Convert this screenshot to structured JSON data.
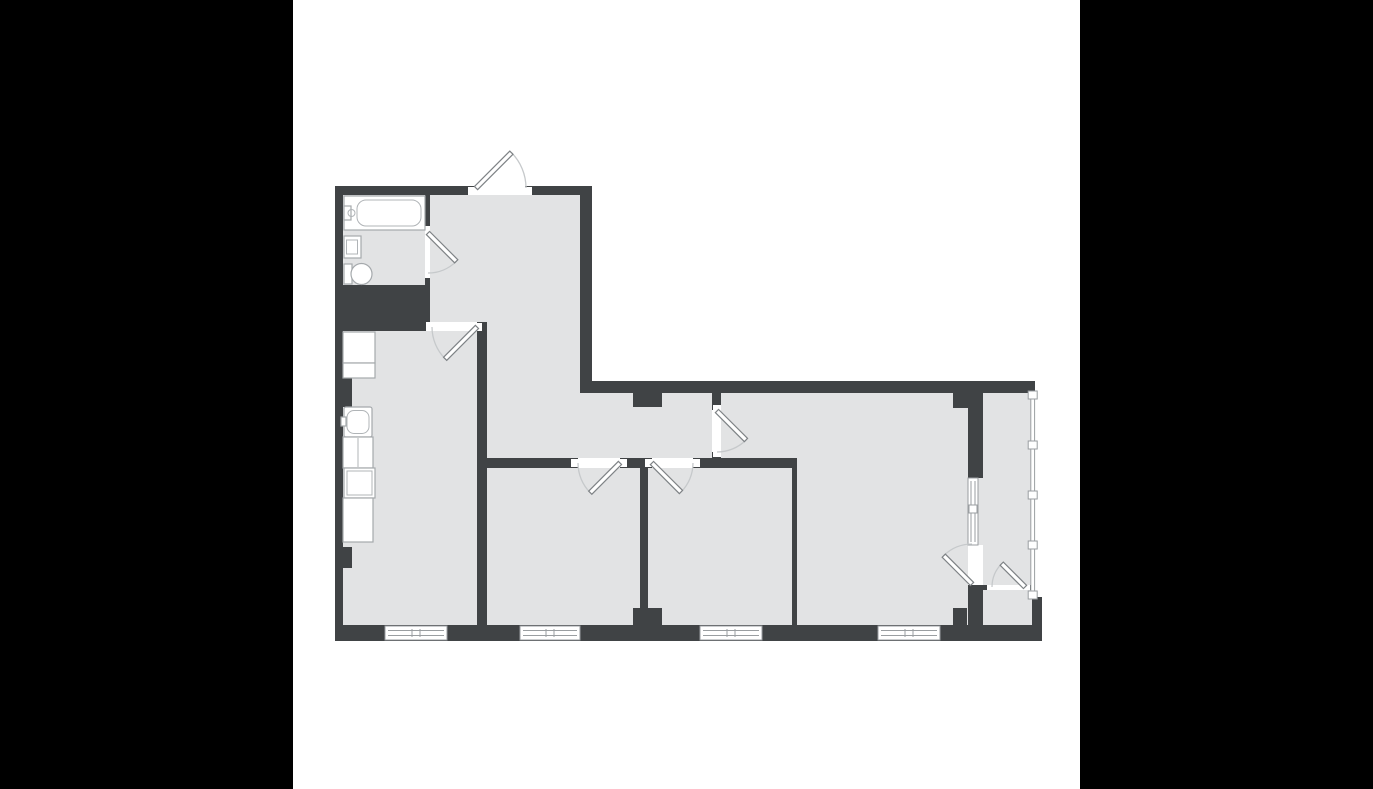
{
  "meta": {
    "type": "apartment-floor-plan",
    "has_text": false
  },
  "palette": {
    "letterbox": "#000000",
    "canvas": "#ffffff",
    "wall": "#404345",
    "floor": "#e2e3e4",
    "window_frame": "#9a9ea1",
    "door_leaf_border": "#7e8285",
    "door_swing_arc": "#c6c9cb",
    "fixture_border": "#a5a9ac"
  },
  "canvas": {
    "x": 293,
    "y": 0,
    "w": 787,
    "h": 789
  },
  "shapes": [
    {
      "n": "plan-canvas",
      "c": "canvas",
      "t": "rect",
      "x": 293,
      "y": 0,
      "w": 787,
      "h": 789
    },
    {
      "n": "floor-left-wing",
      "c": "floor",
      "t": "rect",
      "x": 343,
      "y": 195,
      "w": 248,
      "h": 446
    },
    {
      "n": "floor-right-wing",
      "c": "floor",
      "t": "rect",
      "x": 591,
      "y": 381,
      "w": 444,
      "h": 260
    },
    {
      "n": "top-wall-west",
      "c": "wall",
      "t": "rect",
      "x": 335,
      "y": 186,
      "w": 140,
      "h": 9
    },
    {
      "n": "top-wall-entry-east",
      "c": "wall",
      "t": "rect",
      "x": 525,
      "y": 186,
      "w": 67,
      "h": 9
    },
    {
      "n": "west-wall",
      "c": "wall",
      "t": "rect",
      "x": 335,
      "y": 186,
      "w": 8,
      "h": 455
    },
    {
      "n": "south-wall",
      "c": "wall",
      "t": "rect",
      "x": 335,
      "y": 625,
      "w": 707,
      "h": 16
    },
    {
      "n": "hall-east-wall",
      "c": "wall",
      "t": "rect",
      "x": 580,
      "y": 186,
      "w": 12,
      "h": 207
    },
    {
      "n": "north-wall-east",
      "c": "wall",
      "t": "rect",
      "x": 580,
      "y": 381,
      "w": 455,
      "h": 12
    },
    {
      "n": "bathroom-east-wall-upper",
      "c": "wall",
      "t": "rect",
      "x": 425,
      "y": 195,
      "w": 5,
      "h": 37
    },
    {
      "n": "bathroom-east-wall-lower",
      "c": "wall",
      "t": "rect",
      "x": 425,
      "y": 272,
      "w": 5,
      "h": 14
    },
    {
      "n": "bathroom-kitchen-band",
      "c": "wall",
      "t": "rect",
      "x": 335,
      "y": 285,
      "w": 95,
      "h": 46
    },
    {
      "n": "kitchen-east-wall",
      "c": "wall",
      "t": "rect",
      "x": 477,
      "y": 322,
      "w": 10,
      "h": 319
    },
    {
      "n": "corridor-south-wall-a",
      "c": "wall",
      "t": "rect",
      "x": 487,
      "y": 458,
      "w": 91,
      "h": 10
    },
    {
      "n": "corridor-south-wall-b",
      "c": "wall",
      "t": "rect",
      "x": 620,
      "y": 458,
      "w": 32,
      "h": 10
    },
    {
      "n": "corridor-south-wall-c",
      "c": "wall",
      "t": "rect",
      "x": 693,
      "y": 458,
      "w": 104,
      "h": 10
    },
    {
      "n": "room2-room3-wall",
      "c": "wall",
      "t": "rect",
      "x": 640,
      "y": 468,
      "w": 8,
      "h": 140
    },
    {
      "n": "room2-room3-pillar",
      "c": "wall",
      "t": "rect",
      "x": 633,
      "y": 608,
      "w": 29,
      "h": 17
    },
    {
      "n": "corridor-pillar",
      "c": "wall",
      "t": "rect",
      "x": 633,
      "y": 393,
      "w": 29,
      "h": 14
    },
    {
      "n": "livingroom-door-stub-north",
      "c": "wall",
      "t": "rect",
      "x": 712,
      "y": 393,
      "w": 9,
      "h": 17
    },
    {
      "n": "livingroom-door-stub-south",
      "c": "wall",
      "t": "rect",
      "x": 712,
      "y": 452,
      "w": 9,
      "h": 16
    },
    {
      "n": "room3-livingroom-wall",
      "c": "wall",
      "t": "rect",
      "x": 792,
      "y": 468,
      "w": 5,
      "h": 157
    },
    {
      "n": "balcony-west-wall-upper",
      "c": "wall",
      "t": "rect",
      "x": 968,
      "y": 393,
      "w": 15,
      "h": 85
    },
    {
      "n": "balcony-west-wall-lower",
      "c": "wall",
      "t": "rect",
      "x": 968,
      "y": 585,
      "w": 15,
      "h": 40
    },
    {
      "n": "livingroom-ne-protrusion",
      "c": "wall",
      "t": "rect",
      "x": 953,
      "y": 393,
      "w": 15,
      "h": 15
    },
    {
      "n": "livingroom-se-protrusion",
      "c": "wall",
      "t": "rect",
      "x": 953,
      "y": 608,
      "w": 14,
      "h": 17
    },
    {
      "n": "balcony-divider-west",
      "c": "wall",
      "t": "rect",
      "x": 982,
      "y": 585,
      "w": 10,
      "h": 5
    },
    {
      "n": "balcony-divider-east",
      "c": "wall",
      "t": "rect",
      "x": 1025,
      "y": 585,
      "w": 6,
      "h": 5
    },
    {
      "n": "southeast-block",
      "c": "wall",
      "t": "rect",
      "x": 1032,
      "y": 597,
      "w": 10,
      "h": 43
    },
    {
      "n": "kitchen-wall-nub-upper",
      "c": "wall",
      "t": "rect",
      "x": 343,
      "y": 378,
      "w": 9,
      "h": 29
    },
    {
      "n": "kitchen-wall-nub-lower",
      "c": "wall",
      "t": "rect",
      "x": 343,
      "y": 547,
      "w": 9,
      "h": 21
    },
    {
      "n": "entry-doorway",
      "c": "open",
      "t": "rect",
      "x": 475,
      "y": 186,
      "w": 50,
      "h": 9
    },
    {
      "n": "bathroom-doorway",
      "c": "open",
      "t": "rect",
      "x": 425,
      "y": 232,
      "w": 5,
      "h": 40
    },
    {
      "n": "kitchen-doorway",
      "c": "open",
      "t": "rect",
      "x": 432,
      "y": 322,
      "w": 45,
      "h": 9
    },
    {
      "n": "room2-doorway",
      "c": "open",
      "t": "rect",
      "x": 578,
      "y": 458,
      "w": 42,
      "h": 10
    },
    {
      "n": "room3-doorway",
      "c": "open",
      "t": "rect",
      "x": 652,
      "y": 458,
      "w": 41,
      "h": 10
    },
    {
      "n": "livingroom-doorway",
      "c": "open",
      "t": "rect",
      "x": 712,
      "y": 410,
      "w": 9,
      "h": 42
    },
    {
      "n": "balcony-doorway",
      "c": "open",
      "t": "rect",
      "x": 968,
      "y": 545,
      "w": 15,
      "h": 40
    },
    {
      "n": "balcony-lower-doorway",
      "c": "open",
      "t": "rect",
      "x": 992,
      "y": 585,
      "w": 33,
      "h": 5
    },
    {
      "n": "entry-door-jamb-west",
      "c": "open",
      "t": "rect",
      "x": 468,
      "y": 187,
      "w": 7,
      "h": 8
    },
    {
      "n": "entry-door-jamb-east",
      "c": "open",
      "t": "rect",
      "x": 525,
      "y": 187,
      "w": 7,
      "h": 8
    },
    {
      "n": "bathroom-door-jamb-north",
      "c": "open",
      "t": "rect",
      "x": 425,
      "y": 226,
      "w": 5,
      "h": 6
    },
    {
      "n": "bathroom-door-jamb-south",
      "c": "open",
      "t": "rect",
      "x": 425,
      "y": 272,
      "w": 5,
      "h": 6
    },
    {
      "n": "kitchen-door-jamb-west",
      "c": "open",
      "t": "rect",
      "x": 426,
      "y": 322,
      "w": 6,
      "h": 9
    },
    {
      "n": "kitchen-door-jamb-east",
      "c": "open",
      "t": "rect",
      "x": 477,
      "y": 323,
      "w": 5,
      "h": 8
    },
    {
      "n": "room2-door-jamb-west",
      "c": "open",
      "t": "rect",
      "x": 571,
      "y": 459,
      "w": 7,
      "h": 8
    },
    {
      "n": "room2-door-jamb-east",
      "c": "open",
      "t": "rect",
      "x": 620,
      "y": 459,
      "w": 7,
      "h": 8
    },
    {
      "n": "room3-door-jamb-west",
      "c": "open",
      "t": "rect",
      "x": 645,
      "y": 459,
      "w": 7,
      "h": 8
    },
    {
      "n": "room3-door-jamb-east",
      "c": "open",
      "t": "rect",
      "x": 693,
      "y": 459,
      "w": 7,
      "h": 8
    },
    {
      "n": "livingroom-door-jamb-north",
      "c": "open",
      "t": "rect",
      "x": 713,
      "y": 405,
      "w": 8,
      "h": 5
    },
    {
      "n": "livingroom-door-jamb-south",
      "c": "open",
      "t": "rect",
      "x": 713,
      "y": 452,
      "w": 8,
      "h": 5
    },
    {
      "n": "balcony-lower-door-jamb-west",
      "c": "open",
      "t": "rect",
      "x": 987,
      "y": 585,
      "w": 5,
      "h": 5
    },
    {
      "n": "balcony-lower-door-jamb-east",
      "c": "open",
      "t": "rect",
      "x": 1025,
      "y": 585,
      "w": 5,
      "h": 5
    },
    {
      "n": "kitchen-window-frame",
      "c": "winbox",
      "t": "rect",
      "x": 385,
      "y": 626,
      "w": 62,
      "h": 14
    },
    {
      "n": "kitchen-window-glass-a",
      "c": "winline",
      "t": "line",
      "x1": 388,
      "y1": 630.5,
      "x2": 444,
      "y2": 630.5
    },
    {
      "n": "kitchen-window-glass-b",
      "c": "winline",
      "t": "line",
      "x1": 388,
      "y1": 635.5,
      "x2": 444,
      "y2": 635.5
    },
    {
      "n": "kitchen-window-mullion-a",
      "c": "winline",
      "t": "line",
      "x1": 412,
      "y1": 629,
      "x2": 412,
      "y2": 637
    },
    {
      "n": "kitchen-window-mullion-b",
      "c": "winline",
      "t": "line",
      "x1": 420,
      "y1": 629,
      "x2": 420,
      "y2": 637
    },
    {
      "n": "room2-window-frame",
      "c": "winbox",
      "t": "rect",
      "x": 520,
      "y": 626,
      "w": 60,
      "h": 14
    },
    {
      "n": "room2-window-glass-a",
      "c": "winline",
      "t": "line",
      "x1": 523,
      "y1": 630.5,
      "x2": 577,
      "y2": 630.5
    },
    {
      "n": "room2-window-glass-b",
      "c": "winline",
      "t": "line",
      "x1": 523,
      "y1": 635.5,
      "x2": 577,
      "y2": 635.5
    },
    {
      "n": "room2-window-mullion-a",
      "c": "winline",
      "t": "line",
      "x1": 546,
      "y1": 629,
      "x2": 546,
      "y2": 637
    },
    {
      "n": "room2-window-mullion-b",
      "c": "winline",
      "t": "line",
      "x1": 554,
      "y1": 629,
      "x2": 554,
      "y2": 637
    },
    {
      "n": "room3-window-frame",
      "c": "winbox",
      "t": "rect",
      "x": 700,
      "y": 626,
      "w": 62,
      "h": 14
    },
    {
      "n": "room3-window-glass-a",
      "c": "winline",
      "t": "line",
      "x1": 703,
      "y1": 630.5,
      "x2": 759,
      "y2": 630.5
    },
    {
      "n": "room3-window-glass-b",
      "c": "winline",
      "t": "line",
      "x1": 703,
      "y1": 635.5,
      "x2": 759,
      "y2": 635.5
    },
    {
      "n": "room3-window-mullion-a",
      "c": "winline",
      "t": "line",
      "x1": 727,
      "y1": 629,
      "x2": 727,
      "y2": 637
    },
    {
      "n": "room3-window-mullion-b",
      "c": "winline",
      "t": "line",
      "x1": 735,
      "y1": 629,
      "x2": 735,
      "y2": 637
    },
    {
      "n": "livingroom-window-frame",
      "c": "winbox",
      "t": "rect",
      "x": 878,
      "y": 626,
      "w": 62,
      "h": 14
    },
    {
      "n": "livingroom-window-glass-a",
      "c": "winline",
      "t": "line",
      "x1": 881,
      "y1": 630.5,
      "x2": 937,
      "y2": 630.5
    },
    {
      "n": "livingroom-window-glass-b",
      "c": "winline",
      "t": "line",
      "x1": 881,
      "y1": 635.5,
      "x2": 937,
      "y2": 635.5
    },
    {
      "n": "livingroom-window-mullion-a",
      "c": "winline",
      "t": "line",
      "x1": 905,
      "y1": 629,
      "x2": 905,
      "y2": 637
    },
    {
      "n": "livingroom-window-mullion-b",
      "c": "winline",
      "t": "line",
      "x1": 913,
      "y1": 629,
      "x2": 913,
      "y2": 637
    },
    {
      "n": "balcony-window-frame",
      "c": "winbox",
      "t": "rect",
      "x": 968,
      "y": 478,
      "w": 10,
      "h": 67
    },
    {
      "n": "balcony-window-glass-a",
      "c": "winline",
      "t": "line",
      "x1": 971,
      "y1": 481,
      "x2": 971,
      "y2": 542
    },
    {
      "n": "balcony-window-glass-b",
      "c": "winline",
      "t": "line",
      "x1": 975,
      "y1": 481,
      "x2": 975,
      "y2": 542
    },
    {
      "n": "balcony-window-sash",
      "c": "winmark",
      "t": "rect",
      "x": 969,
      "y": 505,
      "w": 8,
      "h": 8
    },
    {
      "n": "balcony-glazing",
      "c": "winbox",
      "t": "rect",
      "x": 1030.8,
      "y": 393,
      "w": 3.8,
      "h": 204
    },
    {
      "n": "balcony-glazing-mark-1",
      "c": "winmark",
      "t": "rect",
      "x": 1028.2,
      "y": 391,
      "w": 9,
      "h": 8
    },
    {
      "n": "balcony-glazing-mark-2",
      "c": "winmark",
      "t": "rect",
      "x": 1028.2,
      "y": 441,
      "w": 9,
      "h": 8
    },
    {
      "n": "balcony-glazing-mark-3",
      "c": "winmark",
      "t": "rect",
      "x": 1028.2,
      "y": 491,
      "w": 9,
      "h": 8
    },
    {
      "n": "balcony-glazing-mark-4",
      "c": "winmark",
      "t": "rect",
      "x": 1028.2,
      "y": 541,
      "w": 9,
      "h": 8
    },
    {
      "n": "balcony-glazing-mark-5",
      "c": "winmark",
      "t": "rect",
      "x": 1028.2,
      "y": 591,
      "w": 9,
      "h": 8
    },
    {
      "n": "entry-door-swing",
      "c": "arc",
      "t": "path",
      "d": "M 526 188 A 50 50 0 0 0 511.4 152.6"
    },
    {
      "n": "entry-door-leaf",
      "c": "leaf",
      "t": "rect",
      "x": 476,
      "y": 185.8,
      "w": 50,
      "h": 4.5,
      "tr": "rotate(-45 476 188)"
    },
    {
      "n": "bathroom-door-swing",
      "c": "arc",
      "t": "path",
      "d": "M 428 273 A 40 40 0 0 0 456.3 261.3"
    },
    {
      "n": "bathroom-door-leaf",
      "c": "leaf",
      "t": "rect",
      "x": 428,
      "y": 230.8,
      "w": 40,
      "h": 4.5,
      "tr": "rotate(45 428 233)"
    },
    {
      "n": "kitchen-door-swing",
      "c": "arc",
      "t": "path",
      "d": "M 432 327 A 45 45 0 0 0 445.2 358.8"
    },
    {
      "n": "kitchen-door-leaf",
      "c": "leaf",
      "t": "rect",
      "x": 477,
      "y": 324.8,
      "w": 45,
      "h": 4.5,
      "tr": "rotate(135 477 327)"
    },
    {
      "n": "room2-door-swing",
      "c": "arc",
      "t": "path",
      "d": "M 578 463 A 42 42 0 0 0 590.3 492.7"
    },
    {
      "n": "room2-door-leaf",
      "c": "leaf",
      "t": "rect",
      "x": 620,
      "y": 460.8,
      "w": 42,
      "h": 4.5,
      "tr": "rotate(135 620 463)"
    },
    {
      "n": "room3-door-swing",
      "c": "arc",
      "t": "path",
      "d": "M 693 463 A 41 41 0 0 1 681 492"
    },
    {
      "n": "room3-door-leaf",
      "c": "leaf",
      "t": "rect",
      "x": 652,
      "y": 460.8,
      "w": 41,
      "h": 4.5,
      "tr": "rotate(45 652 463)"
    },
    {
      "n": "livingroom-door-swing",
      "c": "arc",
      "t": "path",
      "d": "M 717 452 A 41 41 0 0 0 746 440"
    },
    {
      "n": "livingroom-door-leaf",
      "c": "leaf",
      "t": "rect",
      "x": 717,
      "y": 408.8,
      "w": 41,
      "h": 4.5,
      "tr": "rotate(45 717 411)"
    },
    {
      "n": "balcony-door-swing",
      "c": "arc",
      "t": "path",
      "d": "M 972 544 A 40 40 0 0 0 943.7 555.7"
    },
    {
      "n": "balcony-door-leaf",
      "c": "leaf",
      "t": "rect",
      "x": 972,
      "y": 581.8,
      "w": 40,
      "h": 4.5,
      "tr": "rotate(-135 972 584)"
    },
    {
      "n": "balcony-lower-door-swing",
      "c": "arc",
      "t": "path",
      "d": "M 992 587 A 33 33 0 0 1 1001.7 563.7"
    },
    {
      "n": "balcony-lower-door-leaf",
      "c": "leaf",
      "t": "rect",
      "x": 1025,
      "y": 584.8,
      "w": 33,
      "h": 4.5,
      "tr": "rotate(-135 1025 587)"
    },
    {
      "n": "bathtub",
      "c": "fix",
      "t": "rect",
      "x": 344,
      "y": 196,
      "w": 81,
      "h": 34
    },
    {
      "n": "bathtub-inner",
      "c": "fixline",
      "t": "rect",
      "x": 357,
      "y": 200,
      "w": 64,
      "h": 26,
      "rx": 9
    },
    {
      "n": "bathtub-faucet",
      "c": "fix",
      "t": "rect",
      "x": 344,
      "y": 206,
      "w": 7,
      "h": 14
    },
    {
      "n": "bathtub-faucet-knob",
      "c": "fixline",
      "t": "circle",
      "cx": 351.5,
      "cy": 213,
      "r": 3.5
    },
    {
      "n": "bathroom-sink",
      "c": "fix",
      "t": "rect",
      "x": 344,
      "y": 236,
      "w": 17,
      "h": 22
    },
    {
      "n": "bathroom-sink-basin",
      "c": "fixline",
      "t": "rect",
      "x": 346.5,
      "y": 240,
      "w": 11,
      "h": 14
    },
    {
      "n": "toilet-tank",
      "c": "fix",
      "t": "rect",
      "x": 344,
      "y": 264,
      "w": 8,
      "h": 20
    },
    {
      "n": "toilet-bowl",
      "c": "fix",
      "t": "rect",
      "x": 351,
      "y": 263.5,
      "w": 21,
      "h": 21,
      "rx": 10.5
    },
    {
      "n": "kitchen-fridge",
      "c": "fix",
      "t": "rect",
      "x": 343,
      "y": 332,
      "w": 32,
      "h": 31
    },
    {
      "n": "kitchen-cabinet-a",
      "c": "fix",
      "t": "rect",
      "x": 343,
      "y": 363,
      "w": 32,
      "h": 15
    },
    {
      "n": "kitchen-sink-unit",
      "c": "fix",
      "t": "rect",
      "x": 344,
      "y": 407,
      "w": 28,
      "h": 30,
      "rx": 2
    },
    {
      "n": "kitchen-sink-basin",
      "c": "fixline",
      "t": "rect",
      "x": 347,
      "y": 410.5,
      "w": 22,
      "h": 23,
      "rx": 7
    },
    {
      "n": "kitchen-sink-faucet",
      "c": "fix",
      "t": "rect",
      "x": 341,
      "y": 417,
      "w": 5,
      "h": 9
    },
    {
      "n": "kitchen-cabinet-b",
      "c": "fix",
      "t": "rect",
      "x": 343,
      "y": 437,
      "w": 30,
      "h": 31
    },
    {
      "n": "kitchen-cabinet-b-divider",
      "c": "fixline",
      "t": "line",
      "x1": 358,
      "y1": 438,
      "x2": 358,
      "y2": 467
    },
    {
      "n": "kitchen-stove",
      "c": "fix",
      "t": "rect",
      "x": 344,
      "y": 468,
      "w": 31,
      "h": 30
    },
    {
      "n": "kitchen-stove-inner",
      "c": "fixline",
      "t": "rect",
      "x": 347,
      "y": 471,
      "w": 25,
      "h": 24
    },
    {
      "n": "kitchen-cabinet-c",
      "c": "fix",
      "t": "rect",
      "x": 343,
      "y": 498,
      "w": 30,
      "h": 44
    }
  ]
}
